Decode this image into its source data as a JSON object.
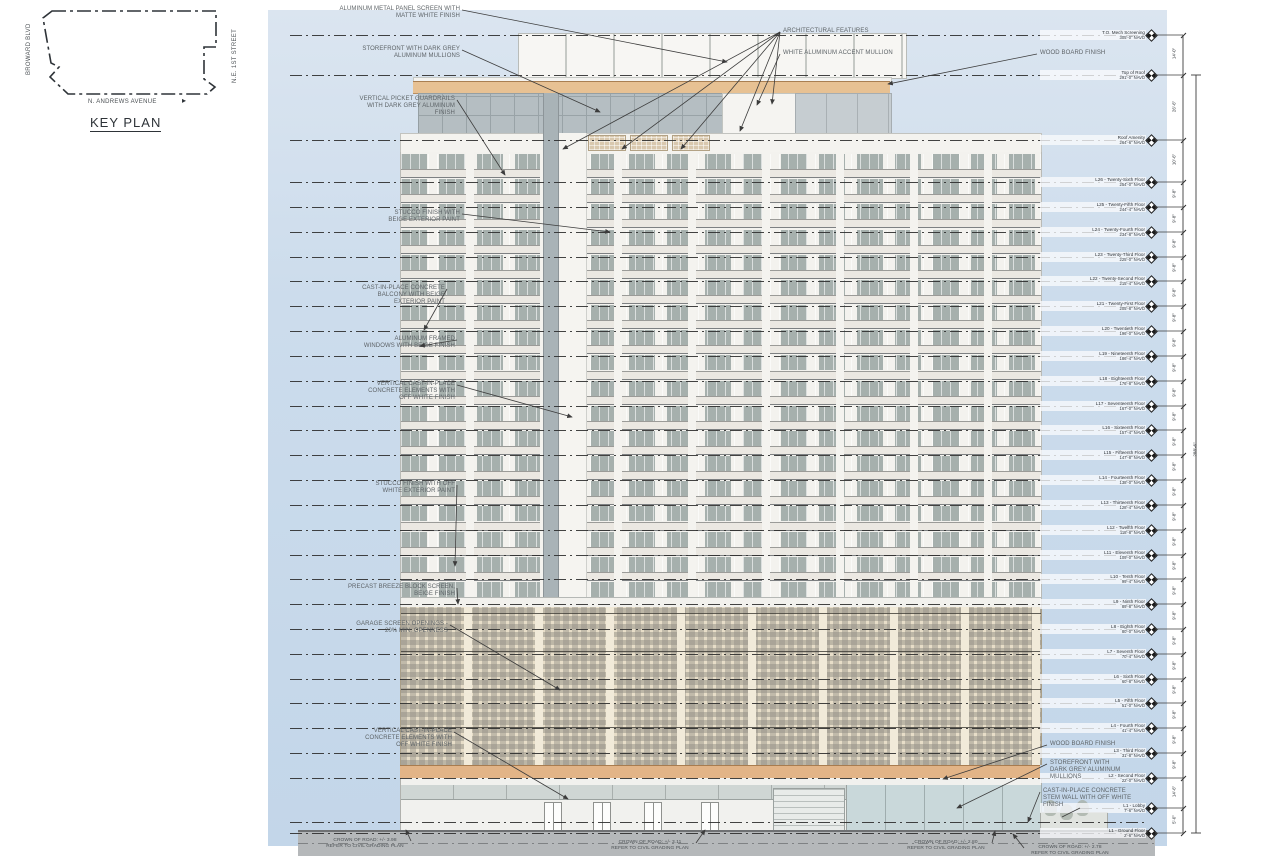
{
  "key_plan": {
    "title": "KEY PLAN",
    "street_left": "BROWARD BLVD",
    "street_right": "N.E. 1ST STREET",
    "street_bottom": "N. ANDREWS AVENUE",
    "north_arrow": "right-arrow-icon"
  },
  "colors": {
    "sky": "#ccdcec",
    "wood_band": "#e7c193",
    "garage_beige": "#e7ddc8",
    "tower_white": "#f3f2ee",
    "window_grey": "#a6b0ad",
    "road_grey": "#b5b8ba",
    "line_black": "#2e2e2e",
    "annotation_grey": "#5d6367"
  },
  "levels": [
    {
      "name": "T.O. Mech Screening",
      "elev": "305'-0\" NAVD",
      "y": 35,
      "dim": "14'-0\""
    },
    {
      "name": "Top of Roof",
      "elev": "291'-0\" NAVD",
      "y": 75,
      "dim": "26'-6\""
    },
    {
      "name": "Roof Amenity",
      "elev": "264'-6\" NAVD",
      "y": 140,
      "dim": "10'-6\""
    },
    {
      "name": "L26 - Twenty-Sixth Floor",
      "elev": "254'-0\" NAVD",
      "y": 182,
      "dim": "9'-8\""
    },
    {
      "name": "L25 - Twenty-Fifth Floor",
      "elev": "244'-4\" NAVD",
      "y": 207,
      "dim": "9'-8\""
    },
    {
      "name": "L24 - Twenty-Fourth Floor",
      "elev": "234'-8\" NAVD",
      "y": 232,
      "dim": "9'-8\""
    },
    {
      "name": "L23 - Twenty-Third Floor",
      "elev": "225'-0\" NAVD",
      "y": 257,
      "dim": "9'-8\""
    },
    {
      "name": "L22 - Twenty-Second Floor",
      "elev": "215'-4\" NAVD",
      "y": 281,
      "dim": "9'-8\""
    },
    {
      "name": "L21 - Twenty-First Floor",
      "elev": "205'-8\" NAVD",
      "y": 306,
      "dim": "9'-8\""
    },
    {
      "name": "L20 - Twentieth Floor",
      "elev": "196'-0\" NAVD",
      "y": 331,
      "dim": "9'-8\""
    },
    {
      "name": "L19 - Nineteenth Floor",
      "elev": "186'-4\" NAVD",
      "y": 356,
      "dim": "9'-8\""
    },
    {
      "name": "L18 - Eighteenth Floor",
      "elev": "176'-8\" NAVD",
      "y": 381,
      "dim": "9'-8\""
    },
    {
      "name": "L17 - Seventeenth Floor",
      "elev": "167'-0\" NAVD",
      "y": 406,
      "dim": "9'-8\""
    },
    {
      "name": "L16 - Sixteenth Floor",
      "elev": "157'-4\" NAVD",
      "y": 430,
      "dim": "9'-8\""
    },
    {
      "name": "L15 - Fifteenth Floor",
      "elev": "147'-8\" NAVD",
      "y": 455,
      "dim": "9'-8\""
    },
    {
      "name": "L14 - Fourteenth Floor",
      "elev": "138'-0\" NAVD",
      "y": 480,
      "dim": "9'-8\""
    },
    {
      "name": "L13 - Thirteenth Floor",
      "elev": "128'-4\" NAVD",
      "y": 505,
      "dim": "9'-8\""
    },
    {
      "name": "L12 - Twelfth Floor",
      "elev": "118'-8\" NAVD",
      "y": 530,
      "dim": "9'-8\""
    },
    {
      "name": "L11 - Eleventh Floor",
      "elev": "109'-0\" NAVD",
      "y": 555,
      "dim": "9'-8\""
    },
    {
      "name": "L10 - Tenth Floor",
      "elev": "99'-4\" NAVD",
      "y": 579,
      "dim": "9'-8\""
    },
    {
      "name": "L9 - Ninth Floor",
      "elev": "89'-8\" NAVD",
      "y": 604,
      "dim": "9'-8\""
    },
    {
      "name": "L8 - Eighth Floor",
      "elev": "80'-0\" NAVD",
      "y": 629,
      "dim": "9'-8\""
    },
    {
      "name": "L7 - Seventh Floor",
      "elev": "70'-4\" NAVD",
      "y": 654,
      "dim": "9'-8\""
    },
    {
      "name": "L6 - Sixth Floor",
      "elev": "60'-8\" NAVD",
      "y": 679,
      "dim": "9'-8\""
    },
    {
      "name": "L5 - Fifth Floor",
      "elev": "51'-0\" NAVD",
      "y": 703,
      "dim": "9'-8\""
    },
    {
      "name": "L4 - Fourth Floor",
      "elev": "41'-4\" NAVD",
      "y": 728,
      "dim": "9'-8\""
    },
    {
      "name": "L3 - Third Floor",
      "elev": "31'-8\" NAVD",
      "y": 753,
      "dim": "9'-8\""
    },
    {
      "name": "L2 - Second Floor",
      "elev": "22'-0\" NAVD",
      "y": 778,
      "dim": "14'-6\""
    },
    {
      "name": "L1 - Lobby",
      "elev": "7'-6\" NAVD",
      "y": 808,
      "dim": "5'-0\"",
      "jog": true
    },
    {
      "name": "L1 - Ground Floor",
      "elev": "2'-6\" NAVD",
      "y": 833
    }
  ],
  "overall_dim": "288'-6\"",
  "annotations": [
    {
      "text": "ALUMINUM METAL PANEL SCREEN WITH\nMATTE WHITE FINISH",
      "x": 460,
      "y": 6,
      "align": "right",
      "tips": [
        [
          727,
          62
        ]
      ]
    },
    {
      "text": "STOREFRONT WITH DARK GREY\nALUMINUM MULLIONS",
      "x": 460,
      "y": 46,
      "align": "right",
      "tips": [
        [
          600,
          112
        ]
      ]
    },
    {
      "text": "VERTICAL PICKET GUARDRAILS\nWITH DARK GREY ALUMINUM\nFINISH",
      "x": 455,
      "y": 96,
      "align": "right",
      "tips": [
        [
          505,
          175
        ]
      ]
    },
    {
      "text": "STUCCO FINISH WITH\nBEIGE EXTERIOR PAINT",
      "x": 460,
      "y": 210,
      "align": "right",
      "tips": [
        [
          610,
          232
        ]
      ]
    },
    {
      "text": "CAST-IN-PLACE CONCRETE\nBALCONY WITH BEIGE\nEXTERIOR PAINT",
      "x": 445,
      "y": 285,
      "align": "right",
      "tips": [
        [
          424,
          330
        ]
      ]
    },
    {
      "text": "ALUMINUM FRAMED\nWINDOWS WITH BEIGE FINISH",
      "x": 455,
      "y": 336,
      "align": "right",
      "tips": [
        [
          420,
          346
        ]
      ]
    },
    {
      "text": "VERTICAL CAST-IN-PLACE\nCONCRETE ELEMENTS WITH\nOFF WHITE FINISH",
      "x": 455,
      "y": 381,
      "align": "right",
      "tips": [
        [
          572,
          417
        ]
      ]
    },
    {
      "text": "STUCCO FINISH WITH OFF\nWHITE EXTERIOR PAINT",
      "x": 455,
      "y": 481,
      "align": "right",
      "tips": [
        [
          455,
          566
        ]
      ]
    },
    {
      "text": "PRECAST BREEZE BLOCK SCREEN,\nBEIGE FINISH",
      "x": 455,
      "y": 584,
      "align": "right",
      "tips": [
        [
          458,
          604
        ]
      ]
    },
    {
      "text": "GARAGE SCREEN OPENINGS -\n20% MIN. OPENNESS",
      "x": 448,
      "y": 621,
      "align": "right",
      "tips": [
        [
          560,
          690
        ]
      ]
    },
    {
      "text": "VERTICAL CAST-IN-PLACE\nCONCRETE ELEMENTS WITH\nOFF WHITE FINISH",
      "x": 452,
      "y": 728,
      "align": "right",
      "tips": [
        [
          568,
          799
        ]
      ]
    },
    {
      "text": "ARCHITECTURAL FEATURES",
      "x": 783,
      "y": 28,
      "align": "left",
      "tips": [
        [
          563,
          149
        ],
        [
          622,
          149
        ],
        [
          681,
          149
        ],
        [
          740,
          131
        ],
        [
          772,
          104
        ]
      ]
    },
    {
      "text": "WHITE ALUMINUM ACCENT MULLION",
      "x": 783,
      "y": 50,
      "align": "left",
      "tips": [
        [
          757,
          105
        ]
      ]
    },
    {
      "text": "WOOD BOARD FINISH",
      "x": 1040,
      "y": 50,
      "align": "left",
      "tips": [
        [
          888,
          84
        ]
      ]
    },
    {
      "text": "WOOD BOARD FINISH",
      "x": 1050,
      "y": 741,
      "align": "left",
      "tips": [
        [
          943,
          779
        ]
      ]
    },
    {
      "text": "STOREFRONT WITH\nDARK GREY ALUMINUM\nMULLIONS",
      "x": 1050,
      "y": 760,
      "align": "left",
      "tips": [
        [
          957,
          808
        ]
      ]
    },
    {
      "text": "CAST-IN-PLACE CONCRETE\nSTEM WALL WITH OFF WHITE\nFINISH",
      "x": 1043,
      "y": 788,
      "align": "left",
      "tips": [
        [
          1028,
          822
        ]
      ]
    },
    {
      "text": "CROWN OF ROAD: +/- 3.98\nREFER TO CIVIL GRADING PLAN",
      "x": 365,
      "y": 838,
      "align": "center",
      "tips": [
        [
          406,
          830
        ]
      ]
    },
    {
      "text": "CROWN OF ROAD: +/- 3.11\nREFER TO CIVIL GRADING PLAN",
      "x": 650,
      "y": 840,
      "align": "center",
      "tips": [
        [
          705,
          830
        ]
      ]
    },
    {
      "text": "CROWN OF ROAD: +/- 2.80\nREFER TO CIVIL GRADING PLAN",
      "x": 946,
      "y": 840,
      "align": "center",
      "tips": [
        [
          995,
          831
        ]
      ]
    },
    {
      "text": "CROWN OF ROAD: +/- 2.78\nREFER TO CIVIL GRADING PLAN",
      "x": 1070,
      "y": 845,
      "align": "center",
      "tips": [
        [
          1013,
          834
        ]
      ]
    }
  ]
}
